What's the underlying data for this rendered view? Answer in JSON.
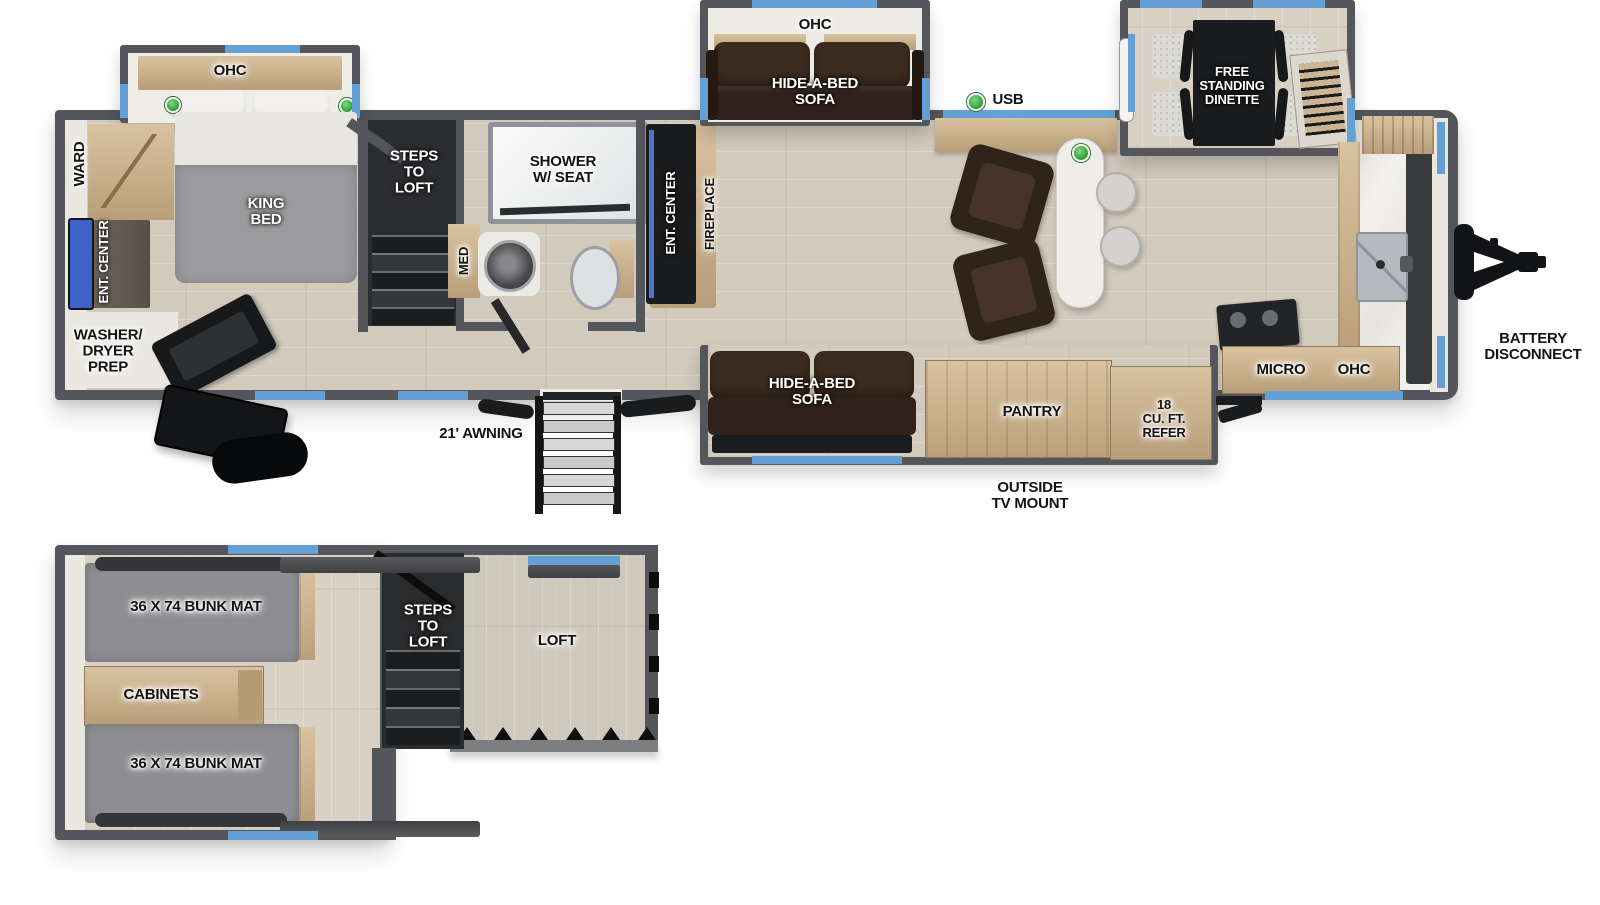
{
  "main_plan": {
    "bedroom": {
      "ohc": "OHC",
      "ward": "WARD",
      "ent_center": "ENT. CENTER",
      "washer_dryer": "WASHER/\nDRYER\nPREP",
      "king_bed": "KING\nBED"
    },
    "steps_to_loft": "STEPS\nTO\nLOFT",
    "bathroom": {
      "med": "MED",
      "shower": "SHOWER\nW/ SEAT"
    },
    "living": {
      "ent_center": "ENT. CENTER",
      "fireplace": "FIREPLACE",
      "ohc": "OHC",
      "hide_a_bed_top": "HIDE-A-BED\nSOFA",
      "usb": "USB",
      "hide_a_bed_bottom": "HIDE-A-BED\nSOFA"
    },
    "kitchen": {
      "dinette": "FREE\nSTANDING\nDINETTE",
      "pantry": "PANTRY",
      "refer": "18\nCU. FT.\nREFER",
      "micro": "MICRO",
      "ohc": "OHC"
    },
    "exterior": {
      "battery": "BATTERY\nDISCONNECT",
      "awning": "21' AWNING",
      "outside_tv": "OUTSIDE\nTV MOUNT"
    }
  },
  "loft_plan": {
    "bunk_front": "36 X 74 BUNK MAT",
    "cabinets": "CABINETS",
    "bunk_rear": "36 X 74 BUNK MAT",
    "steps_to_loft": "STEPS\nTO\nLOFT",
    "loft": "LOFT"
  },
  "colors": {
    "wall": "#54565b",
    "window_accent": "#64a0d4",
    "indicator_green": "#36a83d",
    "floor_wood": "#d2cabc",
    "sofa_brown": "#3c2b1f",
    "counter_marble": "#f3f1ed"
  }
}
